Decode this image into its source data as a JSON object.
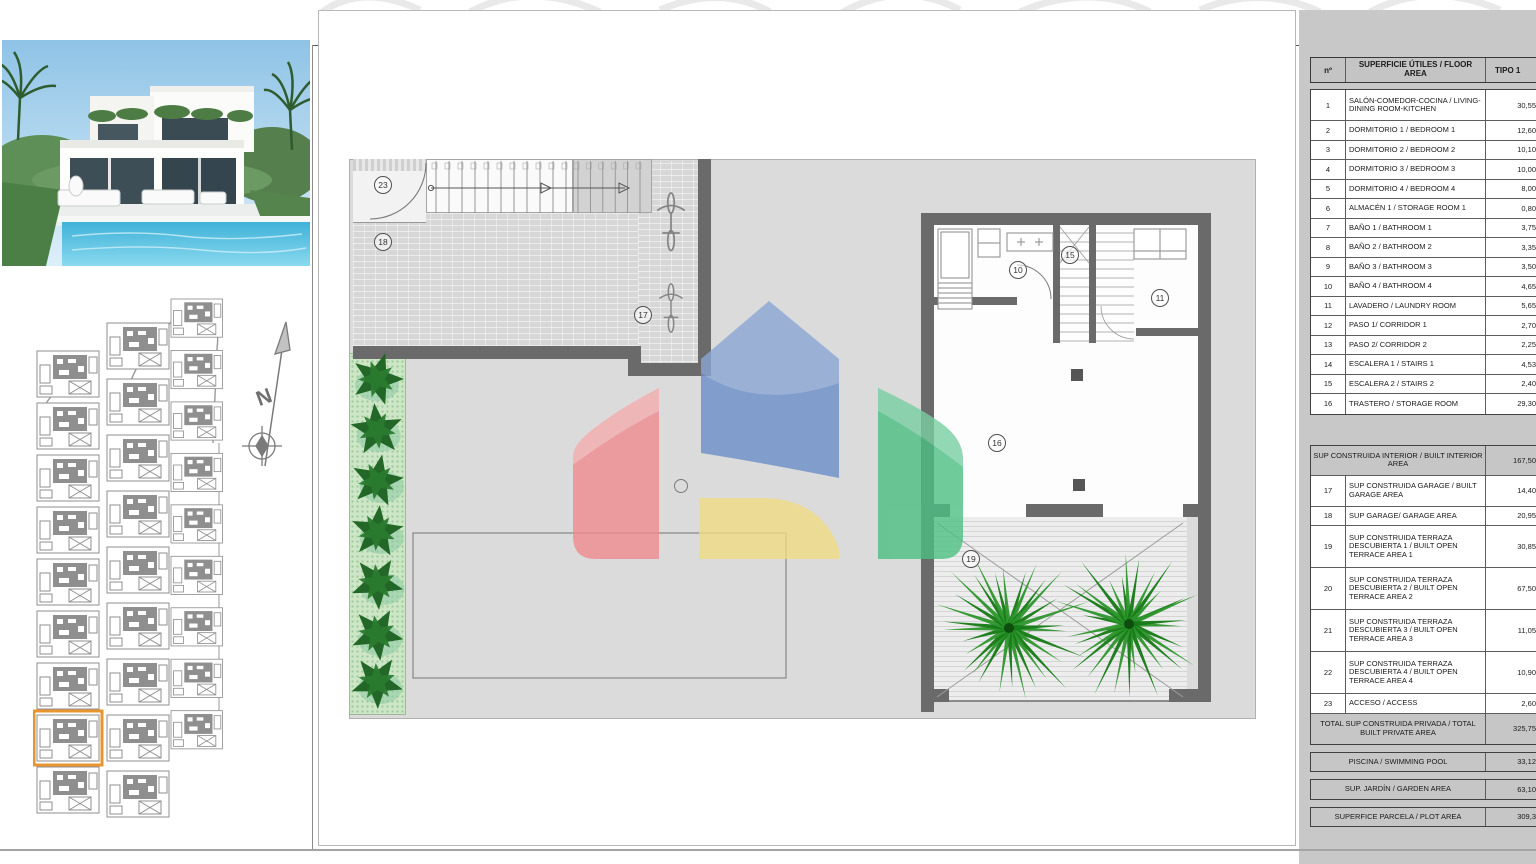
{
  "panel": {
    "header": {
      "num": "nº",
      "area": "SUPERFICIE ÚTILES / FLOOR AREA",
      "type": "TIPO 1"
    },
    "rooms": [
      {
        "num": "1",
        "label": "SALÓN-COMEDOR-COCINA / LIVING-DINING ROOM-KITCHEN",
        "value": "30,55",
        "lines": 2
      },
      {
        "num": "2",
        "label": "DORMITORIO 1 / BEDROOM 1",
        "value": "12,60",
        "lines": 1
      },
      {
        "num": "3",
        "label": "DORMITORIO 2 / BEDROOM 2",
        "value": "10,10",
        "lines": 1
      },
      {
        "num": "4",
        "label": "DORMITORIO 3 / BEDROOM 3",
        "value": "10,00",
        "lines": 1
      },
      {
        "num": "5",
        "label": "DORMITORIO 4 / BEDROOM 4",
        "value": "8,00",
        "lines": 1
      },
      {
        "num": "6",
        "label": "ALMACÉN 1 / STORAGE ROOM 1",
        "value": "0,80",
        "lines": 1
      },
      {
        "num": "7",
        "label": "BAÑO 1 / BATHROOM 1",
        "value": "3,75",
        "lines": 1
      },
      {
        "num": "8",
        "label": "BAÑO 2 / BATHROOM 2",
        "value": "3,35",
        "lines": 1
      },
      {
        "num": "9",
        "label": "BAÑO 3 / BATHROOM 3",
        "value": "3,50",
        "lines": 1
      },
      {
        "num": "10",
        "label": "BAÑO 4 / BATHROOM 4",
        "value": "4,65",
        "lines": 1
      },
      {
        "num": "11",
        "label": "LAVADERO / LAUNDRY ROOM",
        "value": "5,65",
        "lines": 1
      },
      {
        "num": "12",
        "label": "PASO 1/ CORRIDOR 1",
        "value": "2,70",
        "lines": 1
      },
      {
        "num": "13",
        "label": "PASO 2/ CORRIDOR 2",
        "value": "2,25",
        "lines": 1
      },
      {
        "num": "14",
        "label": "ESCALERA 1 / STAIRS 1",
        "value": "4,53",
        "lines": 1
      },
      {
        "num": "15",
        "label": "ESCALERA 2 / STAIRS 2",
        "value": "2,40",
        "lines": 1
      },
      {
        "num": "16",
        "label": "TRASTERO / STORAGE ROOM",
        "value": "29,30",
        "lines": 1
      }
    ],
    "built_interior_row": {
      "label": "SUP CONSTRUIDA INTERIOR / BUILT INTERIOR AREA",
      "value": "167,50"
    },
    "outdoor_rows": [
      {
        "num": "17",
        "label": "SUP CONSTRUIDA GARAGE / BUILT GARAGE AREA",
        "value": "14,40",
        "lines": 2
      },
      {
        "num": "18",
        "label": "SUP GARAGE/ GARAGE AREA",
        "value": "20,95",
        "lines": 1
      },
      {
        "num": "19",
        "label": "SUP CONSTRUIDA TERRAZA DESCUBIERTA 1 / BUILT OPEN TERRACE AREA 1",
        "value": "30,85",
        "lines": 3
      },
      {
        "num": "20",
        "label": "SUP CONSTRUIDA TERRAZA DESCUBIERTA 2 / BUILT OPEN TERRACE AREA 2",
        "value": "67,50",
        "lines": 3
      },
      {
        "num": "21",
        "label": "SUP CONSTRUIDA TERRAZA DESCUBIERTA 3 / BUILT OPEN TERRACE AREA 3",
        "value": "11,05",
        "lines": 3
      },
      {
        "num": "22",
        "label": "SUP CONSTRUIDA TERRAZA DESCUBIERTA 4 / BUILT OPEN TERRACE AREA 4",
        "value": "10,90",
        "lines": 3
      },
      {
        "num": "23",
        "label": "ACCESO / ACCESS",
        "value": "2,60",
        "lines": 1
      }
    ],
    "total_row": {
      "label": "TOTAL SUP CONSTRUIDA PRIVADA / TOTAL BUILT PRIVATE AREA",
      "value": "325,75"
    },
    "pool_row": {
      "label": "PISCINA / SWIMMING POOL",
      "value": "33,12"
    },
    "garden_row": {
      "label": "SUP. JARDÍN / GARDEN AREA",
      "value": "63,10"
    },
    "plot_row": {
      "label": "SUPERFICE PARCELA / PLOT AREA",
      "value": "309,3"
    }
  },
  "plan": {
    "markers": [
      {
        "num": "23"
      },
      {
        "num": "18"
      },
      {
        "num": "17"
      },
      {
        "num": "10"
      },
      {
        "num": "15"
      },
      {
        "num": "11"
      },
      {
        "num": "16"
      },
      {
        "num": "19"
      }
    ]
  },
  "colors": {
    "highlight_orange": "#e8952f",
    "logo_blue": "#6a8ec8",
    "logo_red": "#ef8b8e",
    "logo_yellow": "#f1db83",
    "logo_green": "#4dbf83",
    "pool_blue": "#49b8d8",
    "plant_green": "#1e6323"
  }
}
